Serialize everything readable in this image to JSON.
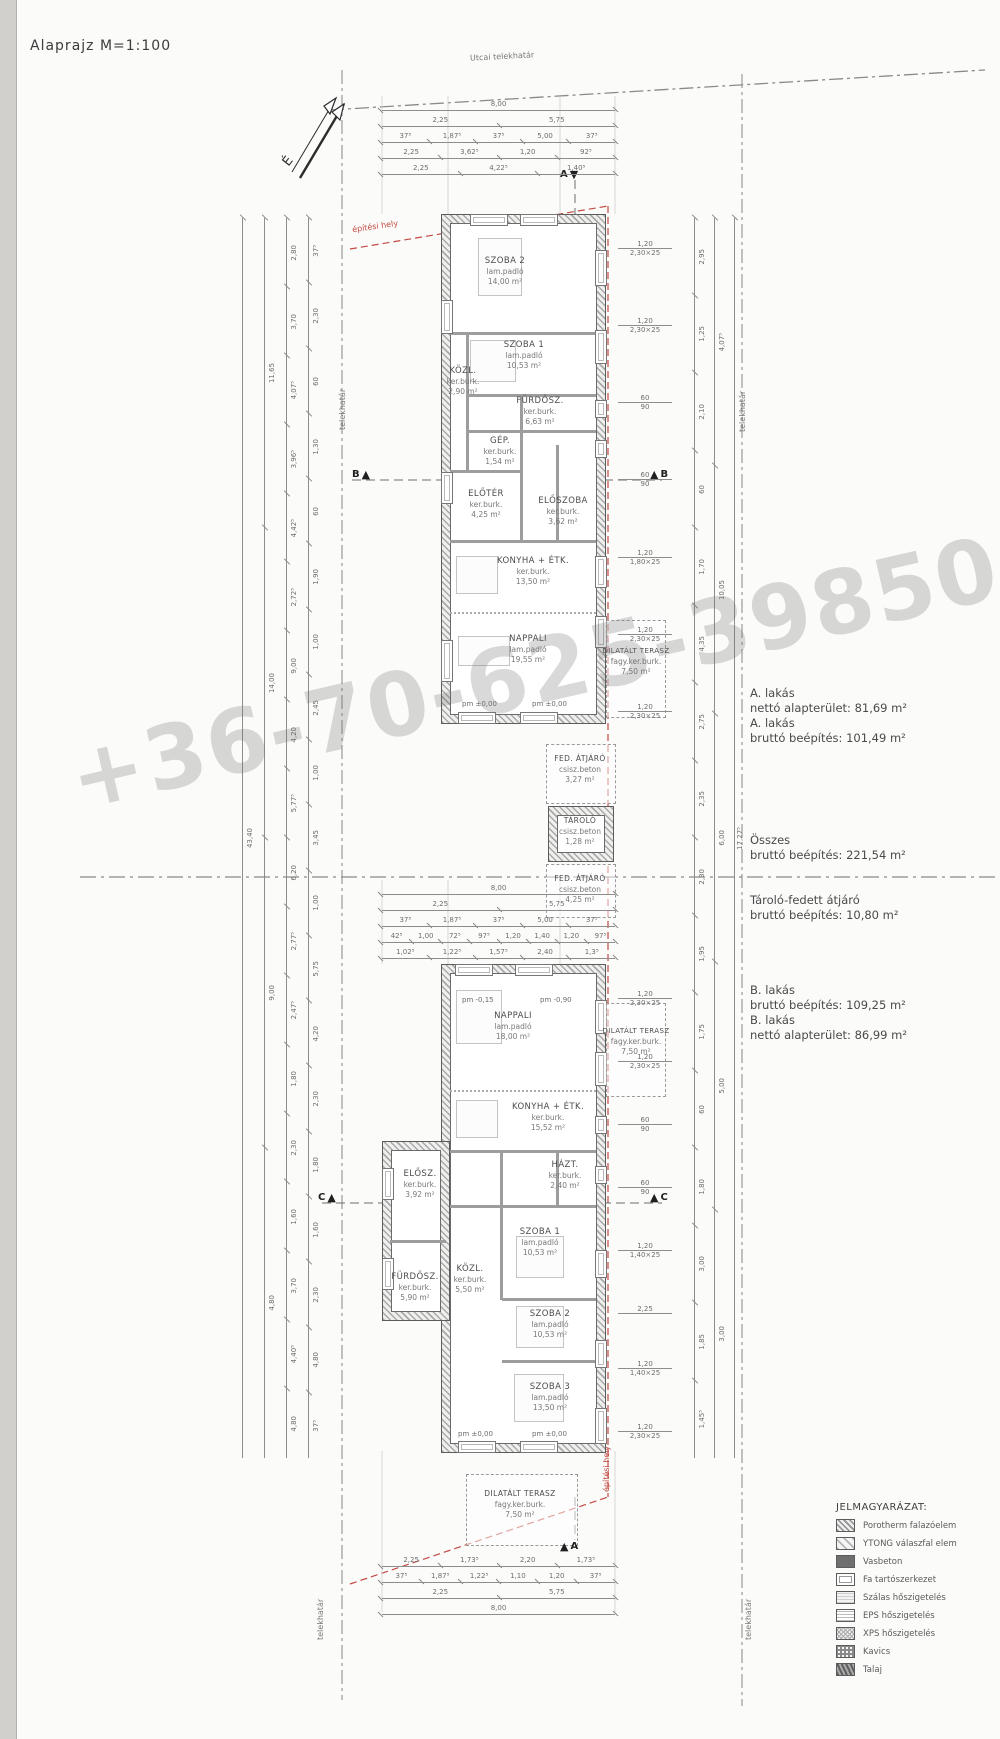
{
  "meta": {
    "title": "Alaprajz M=1:100",
    "north_label": "É"
  },
  "boundaries": {
    "street": "Utcai telekhatár",
    "left": "telekhatár",
    "left_bottom": "telekhatár",
    "right_top": "telekhatár",
    "right_bottom": "telekhatár",
    "building_zone_top": "építési hely",
    "building_zone_bottom": "építési hely",
    "zone_color": "#c24a43"
  },
  "watermark": {
    "text": "+36-70-625-398506 70-431-6"
  },
  "annotations": {
    "a1": "A. lakás",
    "a2": "nettó alapterület: 81,69 m²",
    "a3": "A. lakás",
    "a4": "bruttó beépítés: 101,49 m²",
    "t1": "Összes",
    "t2": "bruttó beépítés: 221,54 m²",
    "s1": "Tároló-fedett átjáró",
    "s2": "bruttó beépítés: 10,80 m²",
    "b1": "B. lakás",
    "b2": "bruttó beépítés: 109,25 m²",
    "b3": "B. lakás",
    "b4": "nettó alapterület: 86,99 m²"
  },
  "rooms": {
    "a": [
      {
        "name": "SZOBA 2",
        "finish": "lam.padló",
        "area": "14,00 m²"
      },
      {
        "name": "SZOBA 1",
        "finish": "lam.padló",
        "area": "10,53 m²"
      },
      {
        "name": "KÖZL.",
        "finish": "ker.burk.",
        "area": "2,90 m²"
      },
      {
        "name": "FÜRDŐSZ.",
        "finish": "ker.burk.",
        "area": "6,63 m²"
      },
      {
        "name": "GÉP.",
        "finish": "ker.burk.",
        "area": "1,54 m²"
      },
      {
        "name": "ELŐTÉR",
        "finish": "ker.burk.",
        "area": "4,25 m²"
      },
      {
        "name": "ELŐSZOBA",
        "finish": "ker.burk.",
        "area": "3,62 m²"
      },
      {
        "name": "KONYHA + ÉTK.",
        "finish": "ker.burk.",
        "area": "13,50 m²"
      },
      {
        "name": "NAPPALI",
        "finish": "lam.padló",
        "area": "19,55 m²"
      },
      {
        "name": "DILATÁLT TERASZ",
        "finish": "fagy.ker.burk.",
        "area": "7,50 m²"
      }
    ],
    "b": [
      {
        "name": "NAPPALI",
        "finish": "lam.padló",
        "area": "18,00 m²"
      },
      {
        "name": "DILATÁLT TERASZ",
        "finish": "fagy.ker.burk.",
        "area": "7,50 m²"
      },
      {
        "name": "KONYHA + ÉTK.",
        "finish": "ker.burk.",
        "area": "15,52 m²"
      },
      {
        "name": "HÁZT.",
        "finish": "ker.burk.",
        "area": "2,40 m²"
      },
      {
        "name": "ELŐSZ.",
        "finish": "ker.burk.",
        "area": "3,92 m²"
      },
      {
        "name": "SZOBA 1",
        "finish": "lam.padló",
        "area": "10,53 m²"
      },
      {
        "name": "KÖZL.",
        "finish": "ker.burk.",
        "area": "5,50 m²"
      },
      {
        "name": "FÜRDŐSZ.",
        "finish": "ker.burk.",
        "area": "5,90 m²"
      },
      {
        "name": "SZOBA 2",
        "finish": "lam.padló",
        "area": "10,53 m²"
      },
      {
        "name": "SZOBA 3",
        "finish": "lam.padló",
        "area": "13,50 m²"
      },
      {
        "name": "DILATÁLT TERASZ",
        "finish": "fagy.ker.burk.",
        "area": "7,50 m²"
      }
    ],
    "shared": [
      {
        "name": "FED. ÁTJÁRÓ",
        "finish": "csisz.beton",
        "area": "3,27 m²"
      },
      {
        "name": "TÁROLÓ",
        "finish": "csisz.beton",
        "area": "1,28 m²"
      },
      {
        "name": "FED. ÁTJÁRÓ",
        "finish": "csisz.beton",
        "area": "4,25 m²"
      }
    ]
  },
  "levels": [
    "pm ±0,00",
    "pm ±0,00",
    "pm ±0,00",
    "pm ±0,00",
    "pm -0,15",
    "pm -0,90"
  ],
  "section_markers": {
    "a": "A",
    "b": "B",
    "c": "C"
  },
  "dims": {
    "top_rows": [
      {
        "values": [
          "8,00"
        ]
      },
      {
        "values": [
          "2,25",
          "5,75"
        ]
      },
      {
        "values": [
          "37⁵",
          "1,87⁵",
          "37⁵",
          "5,00",
          "37⁵"
        ]
      },
      {
        "values": [
          "2,25",
          "3,62⁵",
          "1,20",
          "92⁵"
        ]
      },
      {
        "values": [
          "2,25",
          "4,22⁵",
          "1,40⁵"
        ]
      }
    ],
    "mid_rows": [
      {
        "values": [
          "8,00"
        ]
      },
      {
        "values": [
          "2,25",
          "5,75"
        ]
      },
      {
        "values": [
          "37⁵",
          "1,87⁵",
          "37⁵",
          "5,00",
          "37⁵"
        ]
      },
      {
        "values": [
          "42⁵",
          "1,00",
          "72⁵",
          "97⁵",
          "1,20",
          "1,40",
          "1,20",
          "97⁵"
        ]
      },
      {
        "values": [
          "1,02⁵",
          "1,22⁵",
          "1,57⁵",
          "2,40",
          "1,3⁵"
        ]
      }
    ],
    "bottom_rows": [
      {
        "values": [
          "2,25",
          "1,73⁵",
          "2,20",
          "1,73⁵"
        ]
      },
      {
        "values": [
          "37⁵",
          "1,87⁵",
          "1,22⁵",
          "1,10",
          "1,20",
          "37⁵"
        ]
      },
      {
        "values": [
          "2,25",
          "5,75"
        ]
      },
      {
        "values": [
          "8,00"
        ]
      }
    ],
    "left_cols": [
      {
        "values": [
          "43,40"
        ]
      },
      {
        "values": [
          "11,65",
          "14,00",
          "9,00",
          "4,80"
        ]
      },
      {
        "values": [
          "2,80",
          "3,70",
          "4,07⁵",
          "3,96⁵",
          "4,42⁵",
          "2,72⁵",
          "9,00",
          "4,20",
          "5,77⁵",
          "6,20",
          "2,77⁵",
          "2,47⁵",
          "1,80",
          "2,30",
          "1,60",
          "3,70",
          "4,40⁵",
          "4,80"
        ]
      },
      {
        "values": [
          "37⁵",
          "2,30",
          "60",
          "1,30",
          "60",
          "1,90",
          "1,00",
          "2,45",
          "1,00",
          "3,45",
          "1,00",
          "5,75",
          "4,20",
          "2,30",
          "1,80",
          "1,60",
          "2,30",
          "4,80",
          "37⁵"
        ]
      }
    ],
    "right_cols": [
      {
        "values": [
          "17,27⁵"
        ]
      },
      {
        "values": [
          "4,07⁵",
          "10,05",
          "6,00",
          "5,00",
          "3,00"
        ]
      },
      {
        "values": [
          "2,95",
          "1,25",
          "2,10",
          "60",
          "1,70",
          "4,35",
          "2,75",
          "2,35",
          "2,30",
          "1,95",
          "1,75",
          "60",
          "1,80",
          "3,00",
          "1,85",
          "1,45⁵"
        ]
      }
    ],
    "win_a": [
      {
        "t": "1,20",
        "b": "2,30×25"
      },
      {
        "t": "1,20",
        "b": "2,30×25"
      },
      {
        "t": "60",
        "b": "90"
      },
      {
        "t": "60",
        "b": "90"
      },
      {
        "t": "1,20",
        "b": "1,80×25"
      },
      {
        "t": "1,20",
        "b": "2,30×25"
      },
      {
        "t": "1,20",
        "b": "2,30×25"
      }
    ],
    "win_b": [
      {
        "t": "1,20",
        "b": "2,30×25"
      },
      {
        "t": "1,20",
        "b": "2,30×25"
      },
      {
        "t": "60",
        "b": "90"
      },
      {
        "t": "60",
        "b": "90"
      },
      {
        "t": "1,20",
        "b": "1,40×25"
      },
      {
        "t": "2,25",
        "b": ""
      },
      {
        "t": "1,20",
        "b": "1,40×25"
      },
      {
        "t": "1,20",
        "b": "2,30×25"
      }
    ]
  },
  "legend": {
    "title": "JELMAGYARÁZAT:",
    "items": [
      {
        "name": "Porotherm falazóelem",
        "swatch": "hatch-dense"
      },
      {
        "name": "YTONG válaszfal elem",
        "swatch": "hatch-light"
      },
      {
        "name": "Vasbeton",
        "swatch": "solid-dark"
      },
      {
        "name": "Fa tartószerkezet",
        "swatch": "outline"
      },
      {
        "name": "Szálas hőszigetelés",
        "swatch": "stripes"
      },
      {
        "name": "EPS hőszigetelés",
        "swatch": "grid"
      },
      {
        "name": "XPS hőszigetelés",
        "swatch": "crosshatch"
      },
      {
        "name": "Kavics",
        "swatch": "gravel-dots"
      },
      {
        "name": "Talaj",
        "swatch": "soil-hatch"
      }
    ]
  }
}
